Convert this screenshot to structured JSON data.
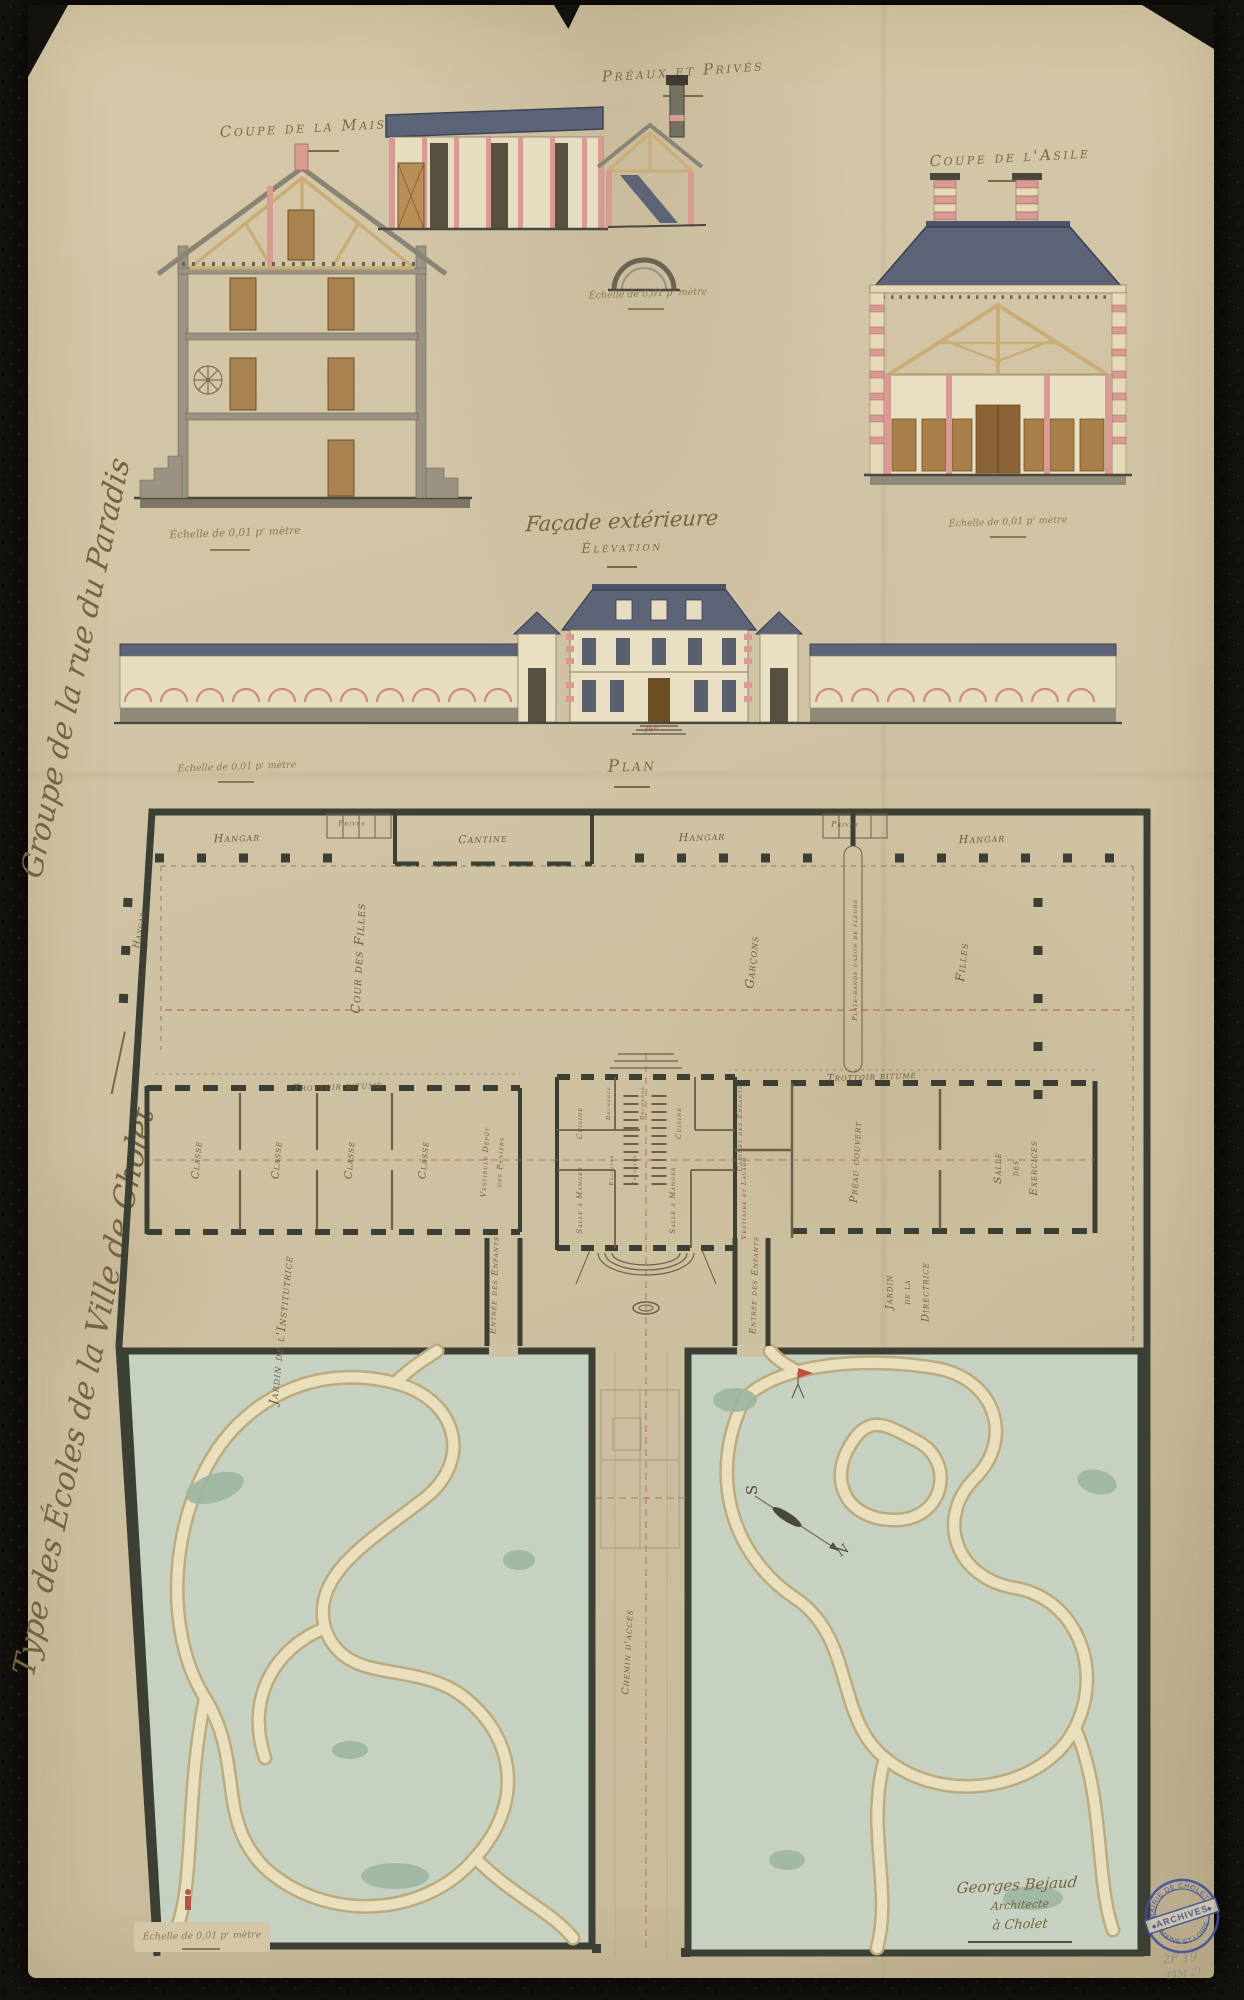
{
  "margin_titles": {
    "project_title": "Type des Écoles de la Ville de Cholet",
    "project_subtitle": "Groupe de la rue du Paradis"
  },
  "drawings": {
    "coupe_maison": {
      "title": "Coupe de la Maison"
    },
    "preaux_prives": {
      "title": "Préaux et Privés"
    },
    "coupe_asile": {
      "title": "Coupe de l'Asile"
    },
    "facade": {
      "title": "Façade extérieure",
      "subtitle": "Élévation",
      "dimension": "36ᵐ"
    },
    "plan": {
      "title": "Plan"
    }
  },
  "scale_note": "Échelle de 0,01 pʳ mètre",
  "plan_labels": {
    "top_row": [
      "Hangar",
      "Privés",
      "Cantine",
      "Hangar",
      "Privés",
      "Hangar"
    ],
    "side_hangar": "Hangar",
    "cour_des_filles": "Cour des Filles",
    "garcons": "Garçons",
    "filles": "Filles",
    "plate_bande": "Plate-bande gazon de fleurs",
    "trottoir_left": "Trottoir bitumé",
    "trottoir_right": "Trottoir bitumé",
    "classes": [
      "Classe",
      "Classe",
      "Classe",
      "Classe"
    ],
    "vestibule_l1": "Vestibule Dépôt",
    "vestibule_l2": "des Paniers",
    "cuisine_left": "Cuisine",
    "salle_a_manger_left": "Salle à Manger",
    "decharge": "Décharge",
    "escalier": "Escalier",
    "cuisine_right": "Cuisine",
    "salle_a_manger_right": "Salle à Manger",
    "cabinet_enfants": "Cabinet des Enfants",
    "vestiaire": "Vestiaire et Lavabo",
    "preau_couvert": "Préau couvert",
    "salle_exercices": {
      "l1": "Salle",
      "l2": "des",
      "l3": "Exercices"
    },
    "jardin_institutrice": "Jardin de l'Institutrice",
    "entree_enfants_left": "Entrée des Enfants",
    "entree_enfants_right": "Entrée des Enfants",
    "jardin_directrice": {
      "l1": "Jardin",
      "l2": "de la",
      "l3": "Directrice"
    },
    "chemin_acces": "Chemin d'accès",
    "compass": {
      "south": "S",
      "north": "N"
    }
  },
  "signature": {
    "name": "Georges Bejaud",
    "role": "Architecte",
    "place": "à Cholet"
  },
  "stamp": {
    "top": "MAIRIE DE CHOLET",
    "middle": "ARCHIVES",
    "bottom": "MAINE ET LOIRE"
  },
  "pencil_note": {
    "l1": "2F 19",
    "l2": "(4M 2)"
  }
}
